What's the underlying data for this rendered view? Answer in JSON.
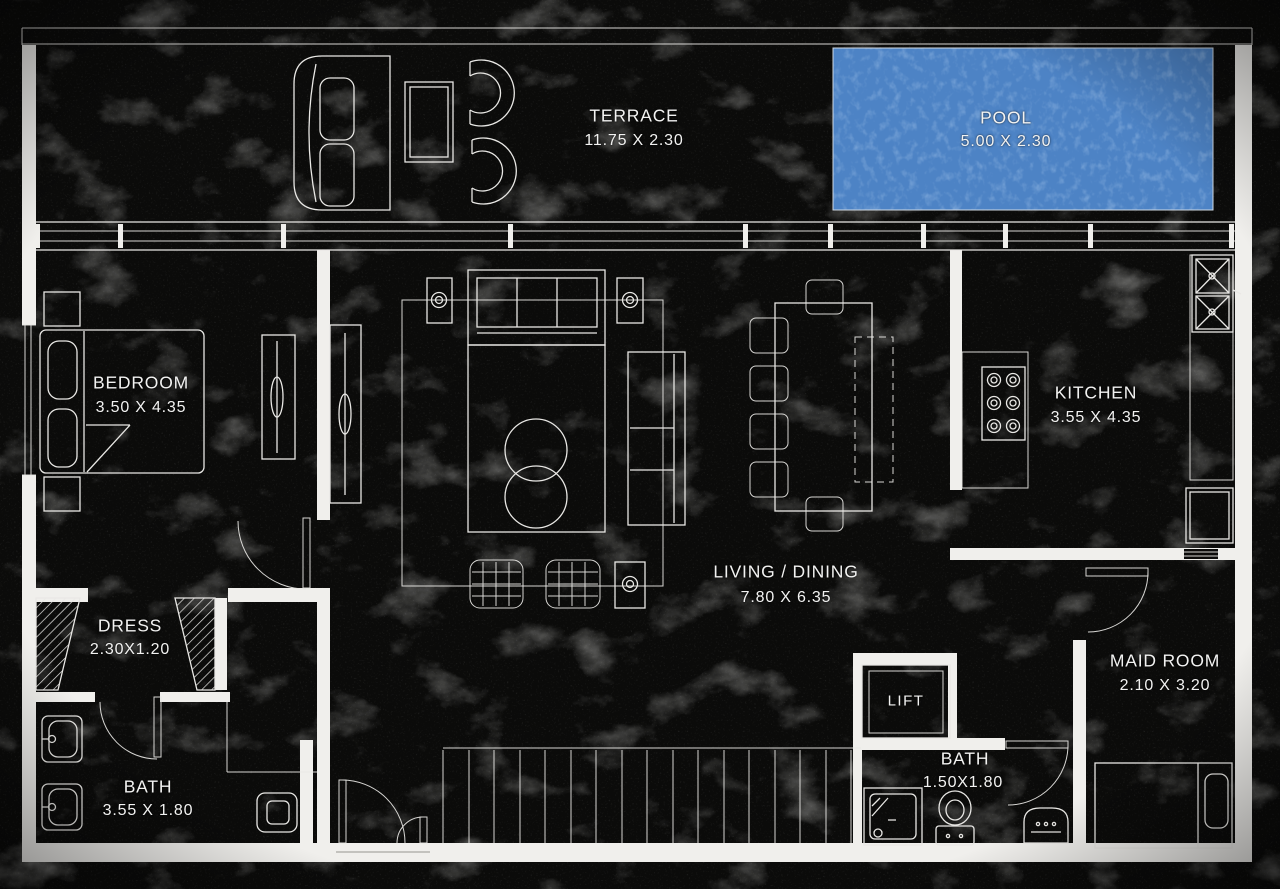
{
  "title": "Apartment Floor Plan",
  "colors": {
    "background": "#0b0b0a",
    "wall": "#f0efec",
    "line": "#e9e8e5",
    "pool_water": "#4d83c5",
    "text": "#f2f2f1"
  },
  "rooms": {
    "terrace": {
      "name": "TERRACE",
      "dims": "11.75 X 2.30"
    },
    "pool": {
      "name": "POOL",
      "dims": "5.00 X 2.30"
    },
    "bedroom": {
      "name": "BEDROOM",
      "dims": "3.50 X 4.35"
    },
    "kitchen": {
      "name": "KITCHEN",
      "dims": "3.55 X 4.35"
    },
    "living_dining": {
      "name": "LIVING / DINING",
      "dims": "7.80 X 6.35"
    },
    "dress": {
      "name": "DRESS",
      "dims": "2.30X1.20"
    },
    "bath_master": {
      "name": "BATH",
      "dims": "3.55 X 1.80"
    },
    "lift": {
      "name": "LIFT",
      "dims": ""
    },
    "bath_service": {
      "name": "BATH",
      "dims": "1.50X1.80"
    },
    "maid_room": {
      "name": "MAID ROOM",
      "dims": "2.10 X 3.20"
    }
  }
}
